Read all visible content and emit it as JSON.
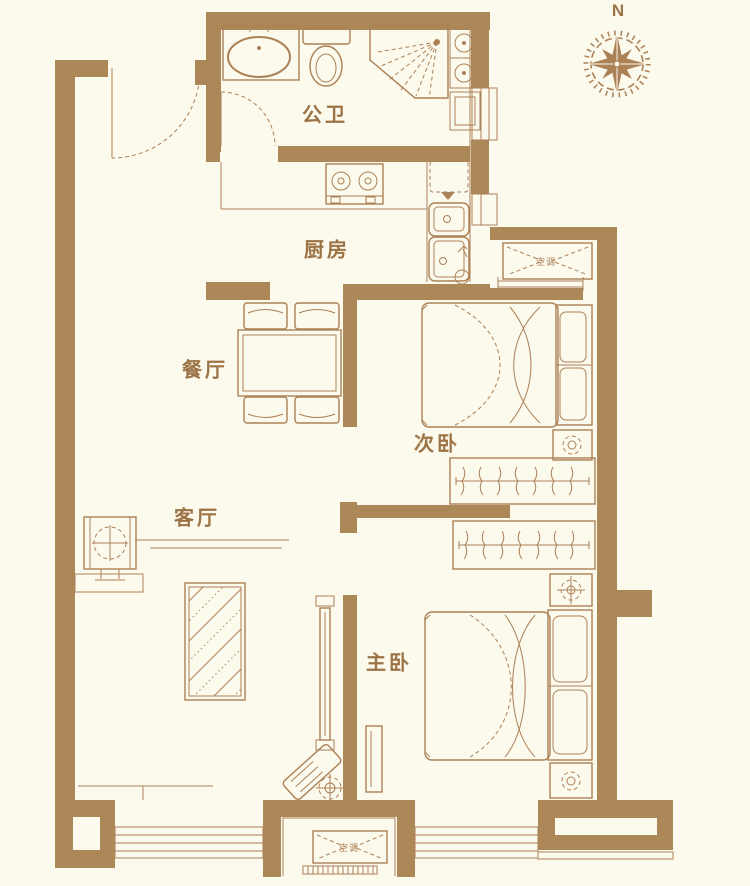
{
  "compass": {
    "north_label": "N"
  },
  "rooms": {
    "bathroom": {
      "label": "公卫"
    },
    "kitchen": {
      "label": "厨房"
    },
    "dining": {
      "label": "餐厅"
    },
    "bedroom2": {
      "label": "次卧"
    },
    "living": {
      "label": "客厅"
    },
    "master": {
      "label": "主卧"
    }
  },
  "symbols": {
    "ac_unit_label": "空调",
    "icons": [
      "compass-icon",
      "ac-unit-icon",
      "door-swing-icon",
      "window-icon",
      "vanity-sink-icon",
      "toilet-icon",
      "shower-icon",
      "washer-icon",
      "stove-icon",
      "fridge-icon",
      "kitchen-sink-icon",
      "floor-drain-icon",
      "dining-table-icon",
      "chair-icon",
      "bed-icon",
      "pillow-icon",
      "nightstand-icon",
      "lamp-icon",
      "wardrobe-icon",
      "hanger-icon",
      "rug-icon",
      "tv-cabinet-icon",
      "sofa-icon",
      "fan-table-icon"
    ]
  },
  "colors": {
    "background": "#fcf9ed",
    "wall": "#ac8758",
    "line": "#ab8156",
    "label": "#9b7345"
  }
}
